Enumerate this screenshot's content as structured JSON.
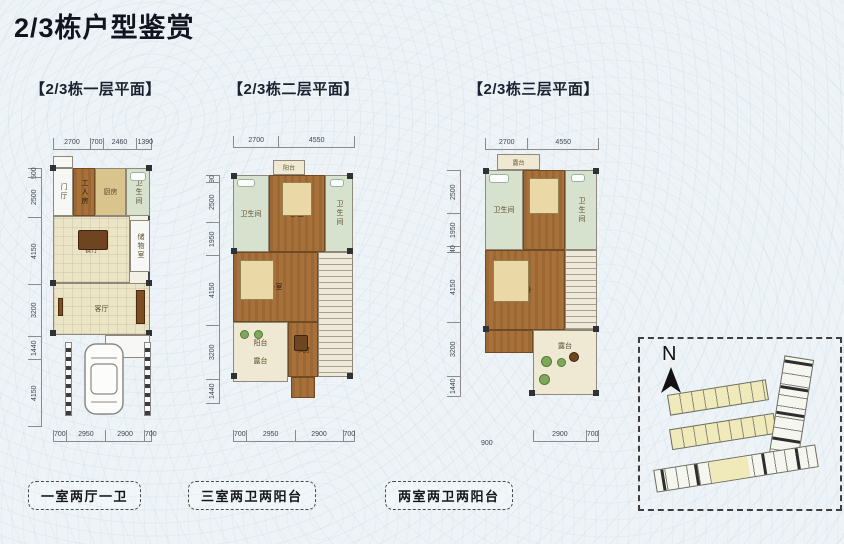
{
  "page": {
    "title": "2/3栋户型鉴赏"
  },
  "plans": [
    {
      "header": "【2/3栋一层平面】",
      "footer": "一室两厅一卫",
      "dims_top": [
        "2700",
        "700",
        "2460",
        "1390"
      ],
      "dims_left": [
        "500",
        "2500",
        "4150",
        "3200",
        "1440",
        "4150"
      ],
      "dims_bottom": [
        "700",
        "2950",
        "2900",
        "700"
      ],
      "rooms": {
        "entry": "门厅",
        "maid": "工人房",
        "kitchen": "厨房",
        "bath": "卫生间",
        "dining": "餐厅",
        "storage": "储物室",
        "living": "客厅"
      }
    },
    {
      "header": "【2/3栋二层平面】",
      "footer": "三室两卫两阳台",
      "dims_top": [
        "2700",
        "4550"
      ],
      "dims_left": [
        "90",
        "2500",
        "1950",
        "4150",
        "3200",
        "1440"
      ],
      "dims_bottom": [
        "700",
        "2950",
        "2900",
        "700"
      ],
      "rooms": {
        "balcony_top": "阳台",
        "bath_left": "卫生间",
        "bedroom_top": "卧室",
        "bath_right": "卫生间",
        "bedroom_mid": "卧室",
        "balcony": "阳台",
        "terrace": "露台",
        "study": "书房"
      }
    },
    {
      "header": "【2/3栋三层平面】",
      "footer": "两室两卫两阳台",
      "dims_top": [
        "2700",
        "4550"
      ],
      "dims_left": [
        "2500",
        "1950",
        "40",
        "4150",
        "3200",
        "1440"
      ],
      "dims_bottom": [
        "2900",
        "700"
      ],
      "dim_extra": "900",
      "rooms": {
        "terrace_top": "露台",
        "bath_left": "卫生间",
        "bedroom": "卧室",
        "bath_right": "卫生间",
        "master": "主卧",
        "terrace": "露台"
      }
    }
  ],
  "sitemap": {
    "north_label": "N"
  },
  "colors": {
    "background": "#edf3f7",
    "wood": "#a8713a",
    "floor": "#ece4c6",
    "bath": "#d6e2ce",
    "site_yellow": "#f0e9ba",
    "wall": "#42464d",
    "title_text": "#10151f"
  }
}
